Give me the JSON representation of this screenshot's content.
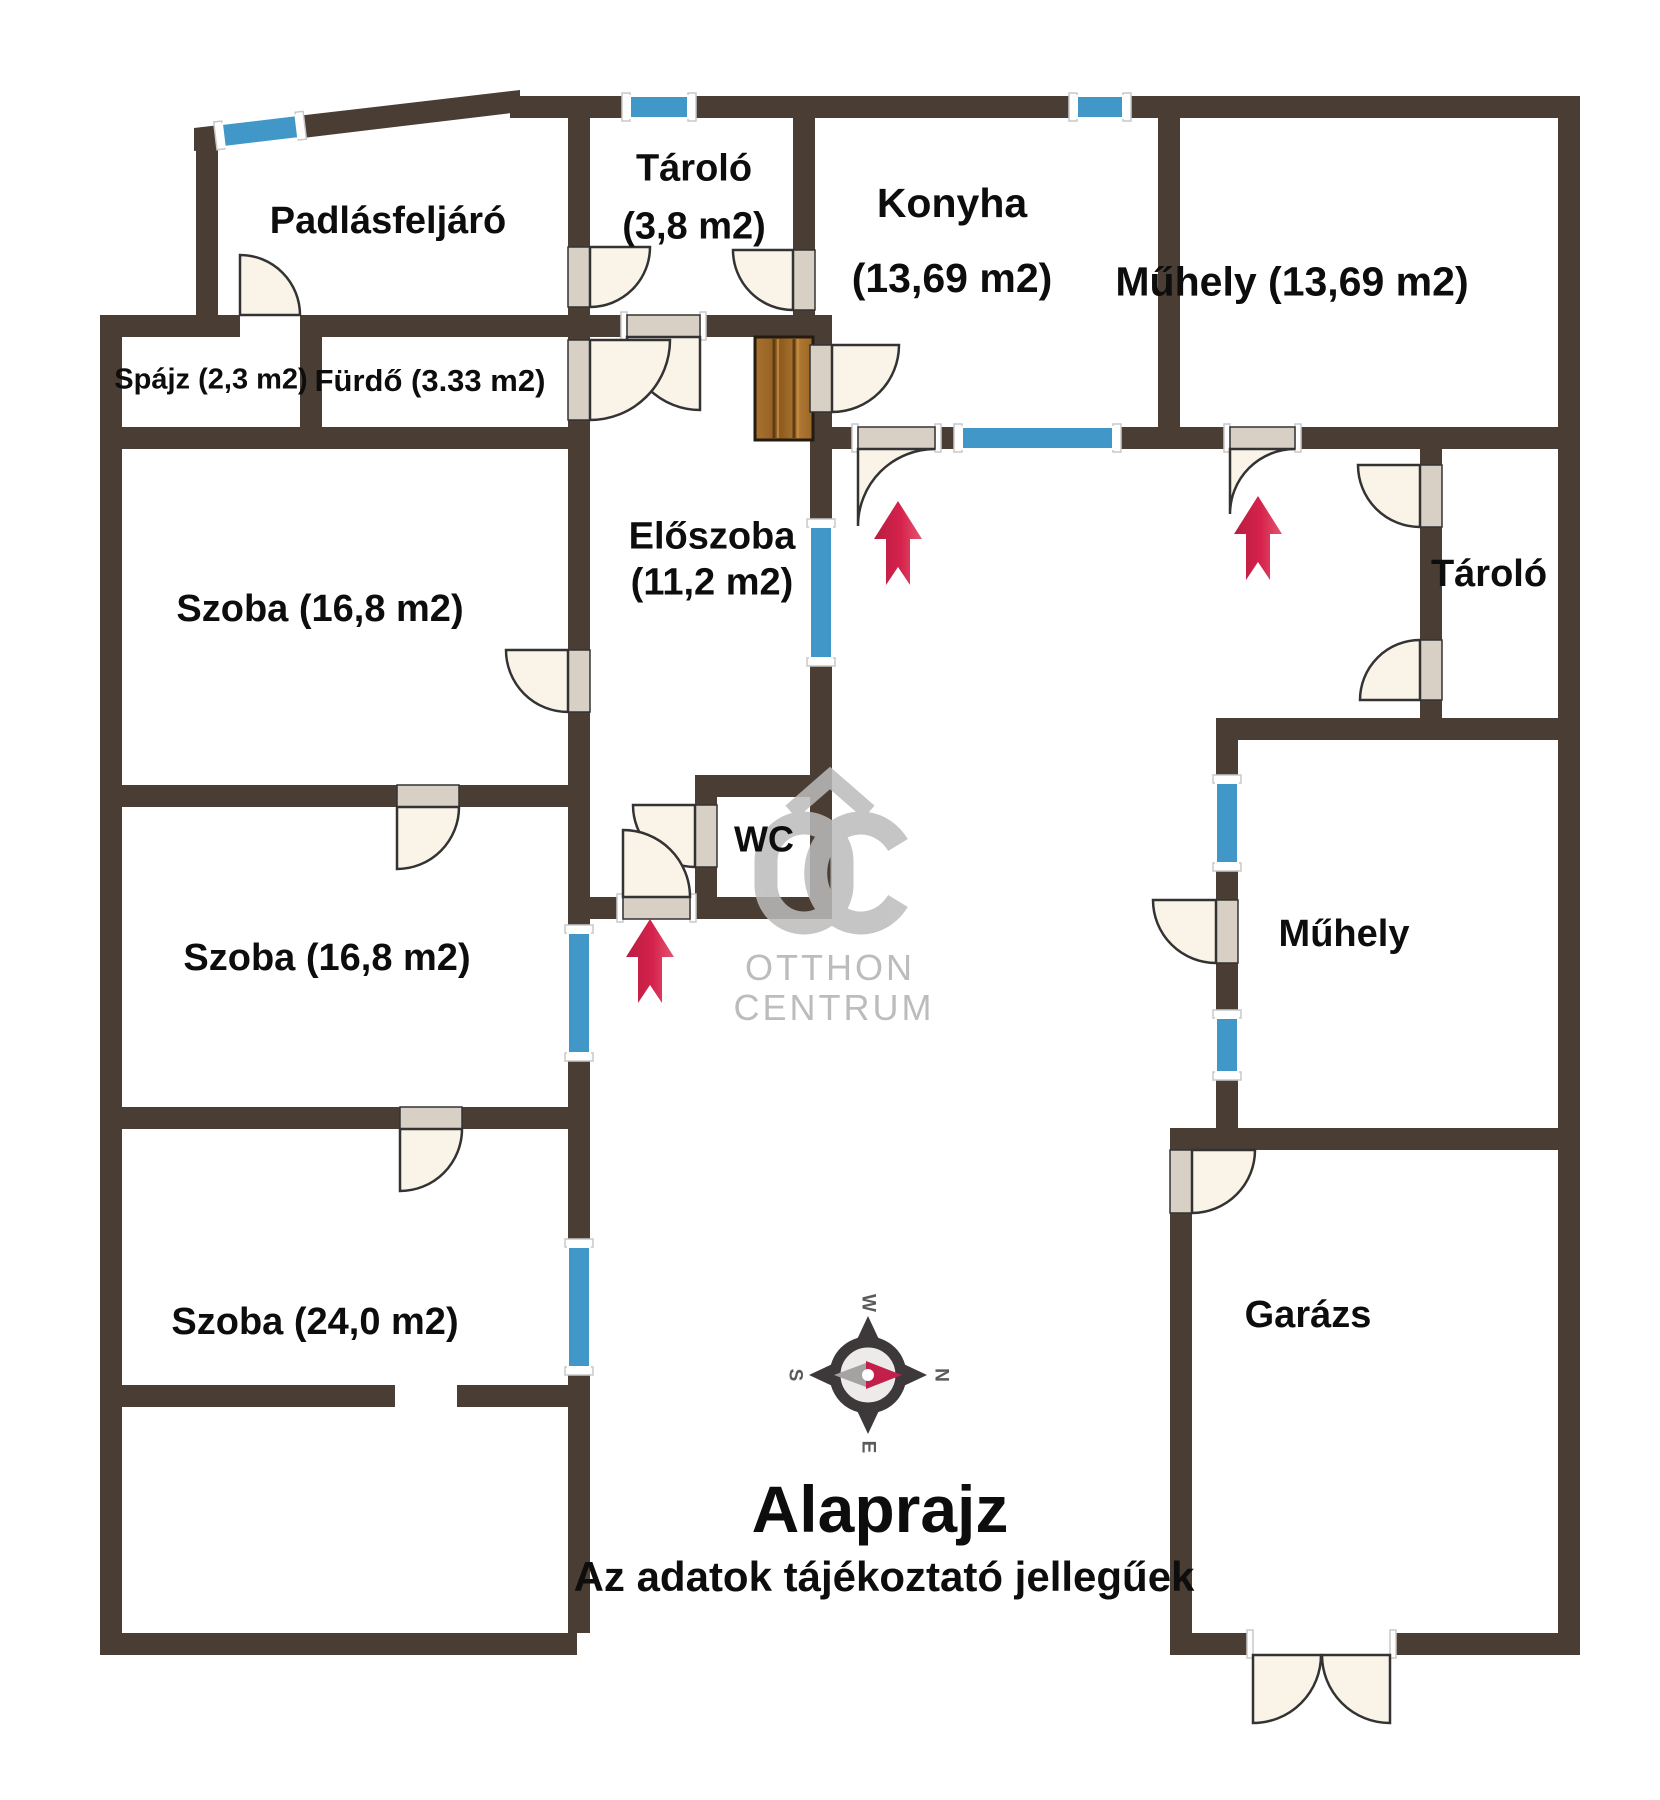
{
  "meta": {
    "plan_title": "Alaprajz",
    "disclaimer": "Az adatok tájékoztató jellegűek"
  },
  "compass": {
    "north": "N",
    "east": "E",
    "south": "S",
    "west": "W"
  },
  "watermark": {
    "brand_top": "OTTHON",
    "brand_bottom": "CENTRUM"
  },
  "rooms": {
    "padlasfeljaro": {
      "name": "Padlásfeljáró"
    },
    "spajz": {
      "name": "Spájz (2,3 m2)"
    },
    "furdo": {
      "name": "Fürdő (3.33 m2)"
    },
    "tarolo_top": {
      "name": "Tároló",
      "area": "(3,8 m2)"
    },
    "konyha": {
      "name": "Konyha",
      "area": "(13,69 m2)"
    },
    "muhely_top": {
      "name": "Műhely (13,69 m2)"
    },
    "eloszoba": {
      "name": "Előszoba",
      "area": "(11,2 m2)"
    },
    "wc": {
      "name": "WC"
    },
    "szoba1": {
      "name": "Szoba (16,8 m2)"
    },
    "szoba2": {
      "name": "Szoba (16,8 m2)"
    },
    "szoba3": {
      "name": "Szoba (24,0 m2)"
    },
    "tarolo_right": {
      "name": "Tároló"
    },
    "muhely_right": {
      "name": "Műhely"
    },
    "garazs": {
      "name": "Garázs"
    }
  },
  "colors": {
    "wall": "#4a3d34",
    "window": "#4198c8",
    "door_leaf": "#faf3e8",
    "door_in_wall": "#d8d0c4",
    "entrance_arrow": "#d5224c",
    "watermark": "#bcbcbc",
    "wood": "#a8722f"
  }
}
